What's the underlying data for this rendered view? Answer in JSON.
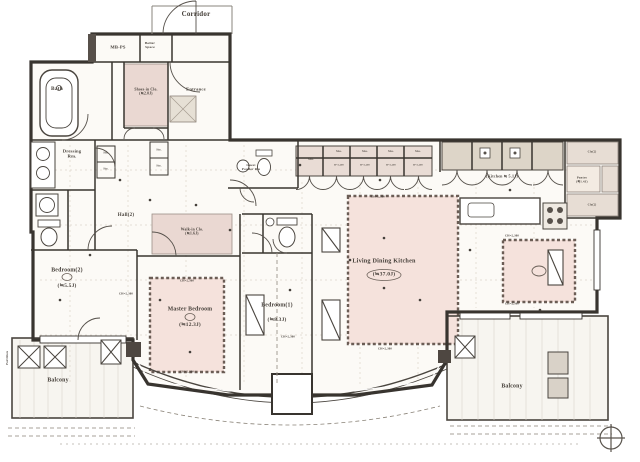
{
  "document": {
    "kind": "apartment floor plan drawing",
    "orientation_mark": "compass-cross"
  },
  "colors": {
    "line": "#3b3733",
    "pink_room": "#ead8d2",
    "rug_fill": "#f5e2dc",
    "rug_border": "#6b5d55",
    "floor": "#fcfaf6",
    "fixture_gray": "#ddd5c8"
  },
  "rooms": [
    {
      "name": "Living Dining Kitchen",
      "size": "≒37.0J"
    },
    {
      "name": "Kitchen",
      "size": "≒5.1J"
    },
    {
      "name": "Master Bedroom",
      "size": "≒12.3J"
    },
    {
      "name": "Bedroom(1)",
      "size": "≒8.3J"
    },
    {
      "name": "Bedroom(2)",
      "size": "≒5.5J"
    },
    {
      "name": "Walk-in Clo.",
      "size": "≒1.6J"
    },
    {
      "name": "Shoes-in Clo.",
      "size": "≒2.0J"
    },
    {
      "name": "Pantry",
      "size": "≒1.4J"
    },
    {
      "name": "Hall(2)"
    },
    {
      "name": "Entrance"
    },
    {
      "name": "Bath"
    },
    {
      "name": "Dressing Rm."
    },
    {
      "name": "Guest Powder Rm"
    },
    {
      "name": "Balcony"
    },
    {
      "name": "Corridor"
    },
    {
      "name": "MB-PS"
    },
    {
      "name": "Boiler Space"
    }
  ],
  "plan": {
    "labels": [
      {
        "name": "corridor",
        "text": "Corridor",
        "x": 196,
        "y": 14,
        "size": 7
      },
      {
        "name": "mb-ps",
        "text": "MB-PS",
        "x": 118,
        "y": 47,
        "size": 4.6
      },
      {
        "name": "boiler-space",
        "text": "Boiler\nSpace",
        "x": 150,
        "y": 45,
        "size": 3.5
      },
      {
        "name": "bath",
        "text": "Bath",
        "x": 57,
        "y": 89,
        "size": 5.4
      },
      {
        "name": "shoes-in-closet",
        "text": "Shoes-in Clo.\n(≒2.0J)",
        "x": 146,
        "y": 92,
        "size": 3.7
      },
      {
        "name": "entrance",
        "text": "Entrance",
        "x": 196,
        "y": 89,
        "size": 4.6
      },
      {
        "name": "dressing-room",
        "text": "Dressing\nRm.",
        "x": 72,
        "y": 154,
        "size": 4.6
      },
      {
        "name": "sto-hall-a",
        "text": "Sto.",
        "x": 106,
        "y": 153,
        "size": 2.7
      },
      {
        "name": "sto-hall-b",
        "text": "Sto.",
        "x": 106,
        "y": 169,
        "size": 2.7
      },
      {
        "name": "sto-hall-c",
        "text": "Sto.",
        "x": 159,
        "y": 150,
        "size": 2.7
      },
      {
        "name": "sto-hall-d",
        "text": "Sto.",
        "x": 159,
        "y": 166,
        "size": 2.7
      },
      {
        "name": "hall",
        "text": "Hall(2)",
        "x": 126,
        "y": 216,
        "size": 5
      },
      {
        "name": "walk-in-closet",
        "text": "Walk-in Clo.\n(≒1.6J)",
        "x": 192,
        "y": 232,
        "size": 3.7
      },
      {
        "name": "guest-powder-room",
        "text": "Guest\nPowder Rm",
        "x": 251,
        "y": 168,
        "size": 3.3
      },
      {
        "name": "bedroom2-name",
        "text": "Bedroom(2)",
        "x": 67,
        "y": 271,
        "size": 5.8
      },
      {
        "name": "bedroom2-size",
        "text": "(≒5.5J)",
        "x": 67,
        "y": 286,
        "size": 5.4
      },
      {
        "name": "master-bedroom-name",
        "text": "Master Bedroom",
        "x": 190,
        "y": 310,
        "size": 5.8
      },
      {
        "name": "master-bedroom-size",
        "text": "(≒12.3J)",
        "x": 190,
        "y": 325,
        "size": 5.4
      },
      {
        "name": "bedroom1-name",
        "text": "Bedroom(1)",
        "x": 277,
        "y": 306,
        "size": 5.8
      },
      {
        "name": "bedroom1-size",
        "text": "(≒8.3J)",
        "x": 277,
        "y": 320,
        "size": 5.4
      },
      {
        "name": "ldk-name",
        "text": "Living Dining Kitchen",
        "x": 384,
        "y": 261,
        "size": 6.2
      },
      {
        "name": "ldk-size",
        "text": "(≒37.0J)",
        "x": 384,
        "y": 275,
        "size": 5.6
      },
      {
        "name": "kitchen-size",
        "text": "(Kitchen ≒ 5.1J)",
        "x": 502,
        "y": 177,
        "size": 4
      },
      {
        "name": "pantry",
        "text": "Pantry\n(≒1.4J)",
        "x": 582,
        "y": 180,
        "size": 3.1
      },
      {
        "name": "closet2-top",
        "text": "Clo(2)",
        "x": 592,
        "y": 152,
        "size": 2.8
      },
      {
        "name": "closet2-bottom",
        "text": "Clo(2)",
        "x": 592,
        "y": 205,
        "size": 2.8
      },
      {
        "name": "balcony-left",
        "text": "Balcony",
        "x": 58,
        "y": 381,
        "size": 5.8
      },
      {
        "name": "balcony-right",
        "text": "Balcony",
        "x": 512,
        "y": 387,
        "size": 5.8
      },
      {
        "name": "sto-1",
        "text": "Sto.",
        "x": 311,
        "y": 160,
        "size": 3
      },
      {
        "name": "sto-2",
        "text": "Sto.",
        "x": 339,
        "y": 152,
        "size": 3
      },
      {
        "name": "sto-3",
        "text": "Sto.",
        "x": 365,
        "y": 152,
        "size": 3
      },
      {
        "name": "sto-4",
        "text": "Sto.",
        "x": 391,
        "y": 152,
        "size": 3
      },
      {
        "name": "sto-5",
        "text": "Sto.",
        "x": 418,
        "y": 152,
        "size": 3
      },
      {
        "name": "sto-h-2",
        "text": "H=2,200",
        "x": 339,
        "y": 166,
        "size": 2.3
      },
      {
        "name": "sto-h-3",
        "text": "H=2,200",
        "x": 365,
        "y": 166,
        "size": 2.3
      },
      {
        "name": "sto-h-4",
        "text": "H=2,200",
        "x": 391,
        "y": 166,
        "size": 2.3
      },
      {
        "name": "sto-h-5",
        "text": "H=2,200",
        "x": 418,
        "y": 166,
        "size": 2.3
      },
      {
        "name": "ch-1",
        "text": "CH=2,300",
        "x": 126,
        "y": 294,
        "size": 2.9
      },
      {
        "name": "ch-2",
        "text": "CH=2,300",
        "x": 187,
        "y": 281,
        "size": 2.9
      },
      {
        "name": "ch-3",
        "text": "CH=2,300",
        "x": 187,
        "y": 372,
        "size": 2.9
      },
      {
        "name": "ch-4",
        "text": "CH=2,300",
        "x": 288,
        "y": 337,
        "size": 2.9
      },
      {
        "name": "ch-5",
        "text": "CH=2,300",
        "x": 378,
        "y": 197,
        "size": 2.9
      },
      {
        "name": "ch-6",
        "text": "CH=2,300",
        "x": 512,
        "y": 236,
        "size": 2.9
      },
      {
        "name": "ch-7",
        "text": "CH=2,300",
        "x": 512,
        "y": 304,
        "size": 2.9
      },
      {
        "name": "ch-8",
        "text": "CH=2,300",
        "x": 385,
        "y": 349,
        "size": 2.9
      },
      {
        "name": "partition",
        "text": "Partition",
        "x": 8,
        "y": 358,
        "size": 3.2,
        "rotate": -90
      }
    ]
  }
}
